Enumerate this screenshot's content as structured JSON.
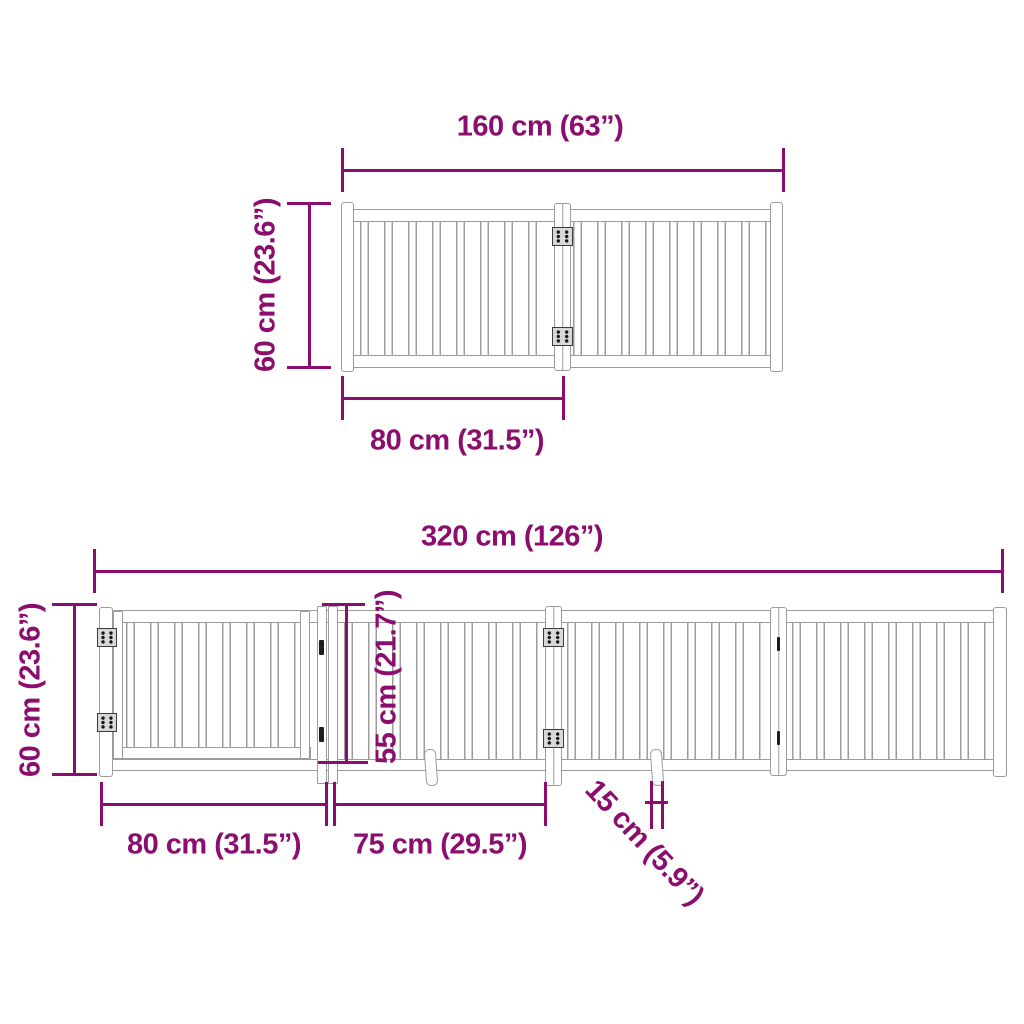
{
  "colors": {
    "dimension": "#8B0E6E",
    "drawing": "#9C9C9C"
  },
  "top_diagram": {
    "total_width": "160 cm (63”)",
    "height": "60 cm (23.6”)",
    "panel_width": "80 cm (31.5”)"
  },
  "bottom_diagram": {
    "total_width": "320 cm (126”)",
    "height": "60 cm (23.6”)",
    "door_height": "55 cm (21.7”)",
    "door_width": "80 cm (31.5”)",
    "panel_width": "75 cm (29.5”)",
    "foot_length": "15 cm (5.9”)"
  }
}
